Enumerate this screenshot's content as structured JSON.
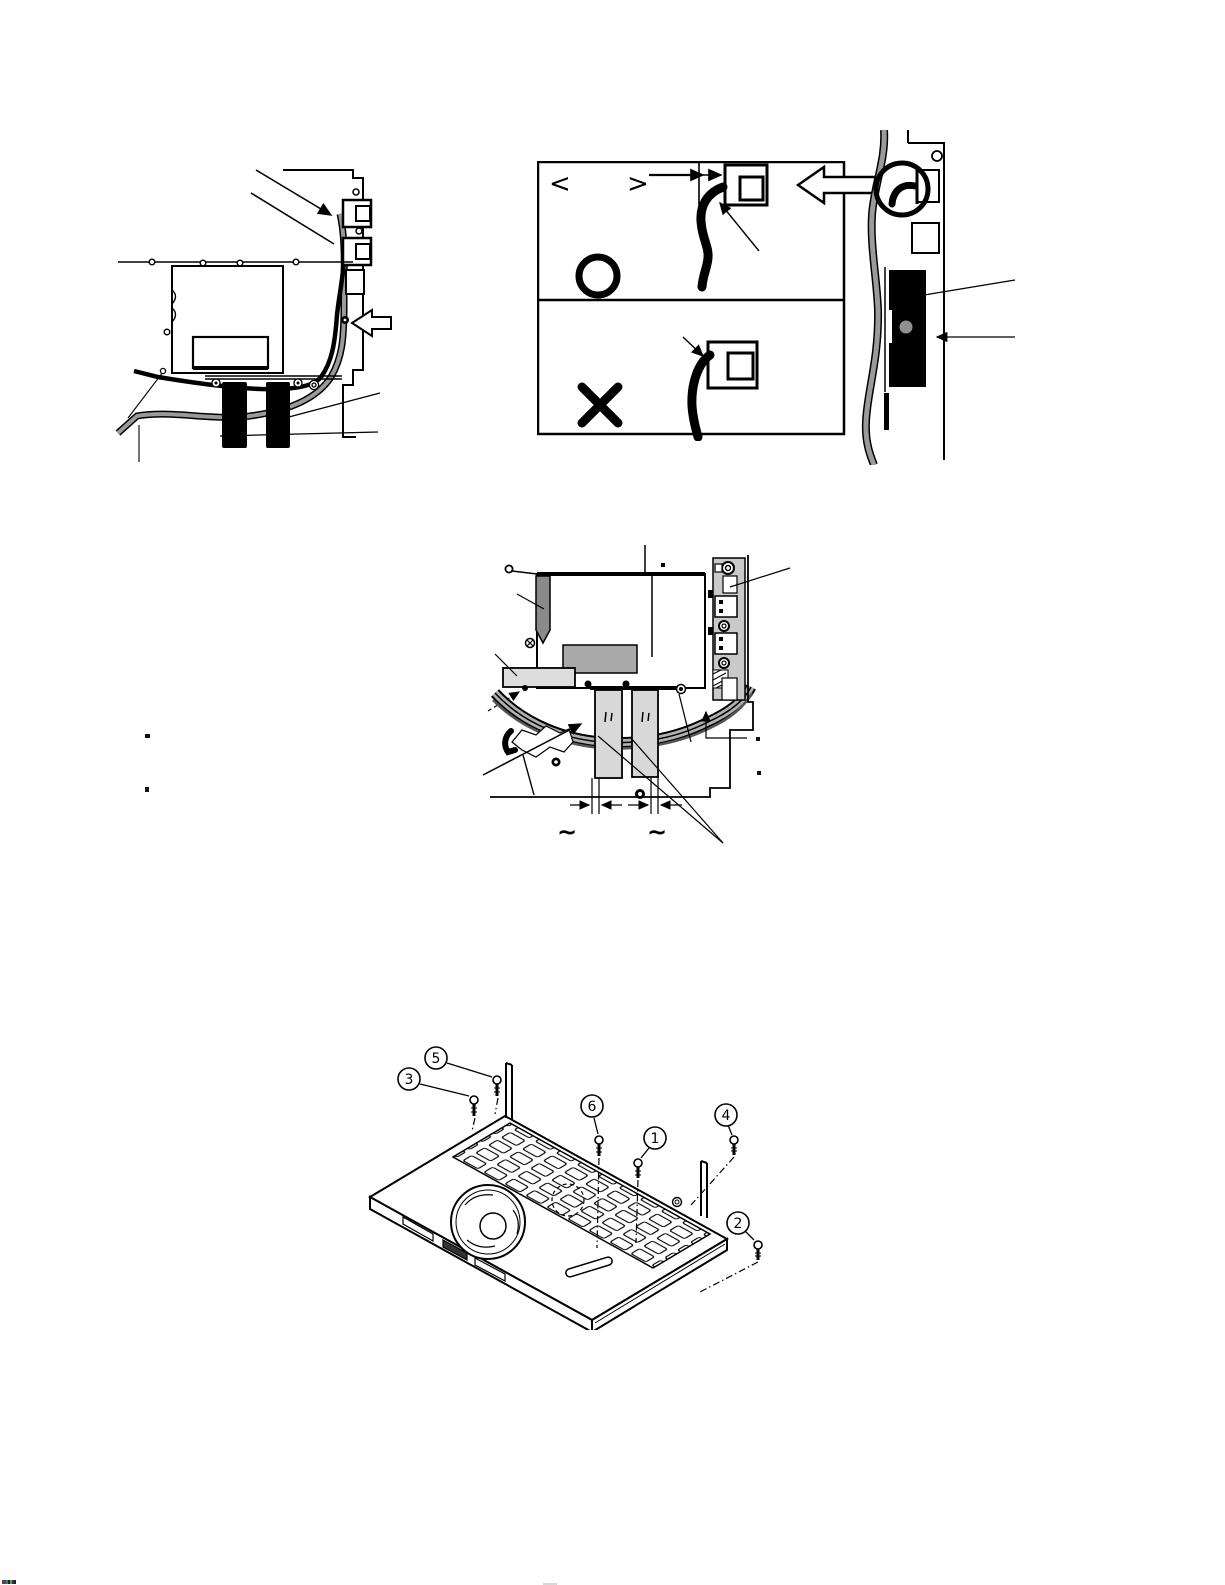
{
  "ok_ng_panel": {
    "bracket_open": "<",
    "bracket_close": ">",
    "icons": {
      "ok": "circle-outline",
      "ng": "cross",
      "pointer": "left-outline-arrow",
      "gap_dimension": "double-headed-arrow"
    }
  },
  "ribbon_panel": {
    "tilde_left": "~",
    "tilde_right": "~"
  },
  "laptop_panel": {
    "screws": [
      {
        "label": "1"
      },
      {
        "label": "2"
      },
      {
        "label": "3"
      },
      {
        "label": "4"
      },
      {
        "label": "5"
      },
      {
        "label": "6"
      }
    ]
  },
  "colors": {
    "line": "#000000",
    "cable_gray": "#8f8f8f",
    "strip_gray": "#c9c9c9",
    "module_gray": "#a9a9a9",
    "ribbon_gray": "#d8d8d8",
    "bar_light": "#dddddd",
    "sponge": "#000000"
  }
}
